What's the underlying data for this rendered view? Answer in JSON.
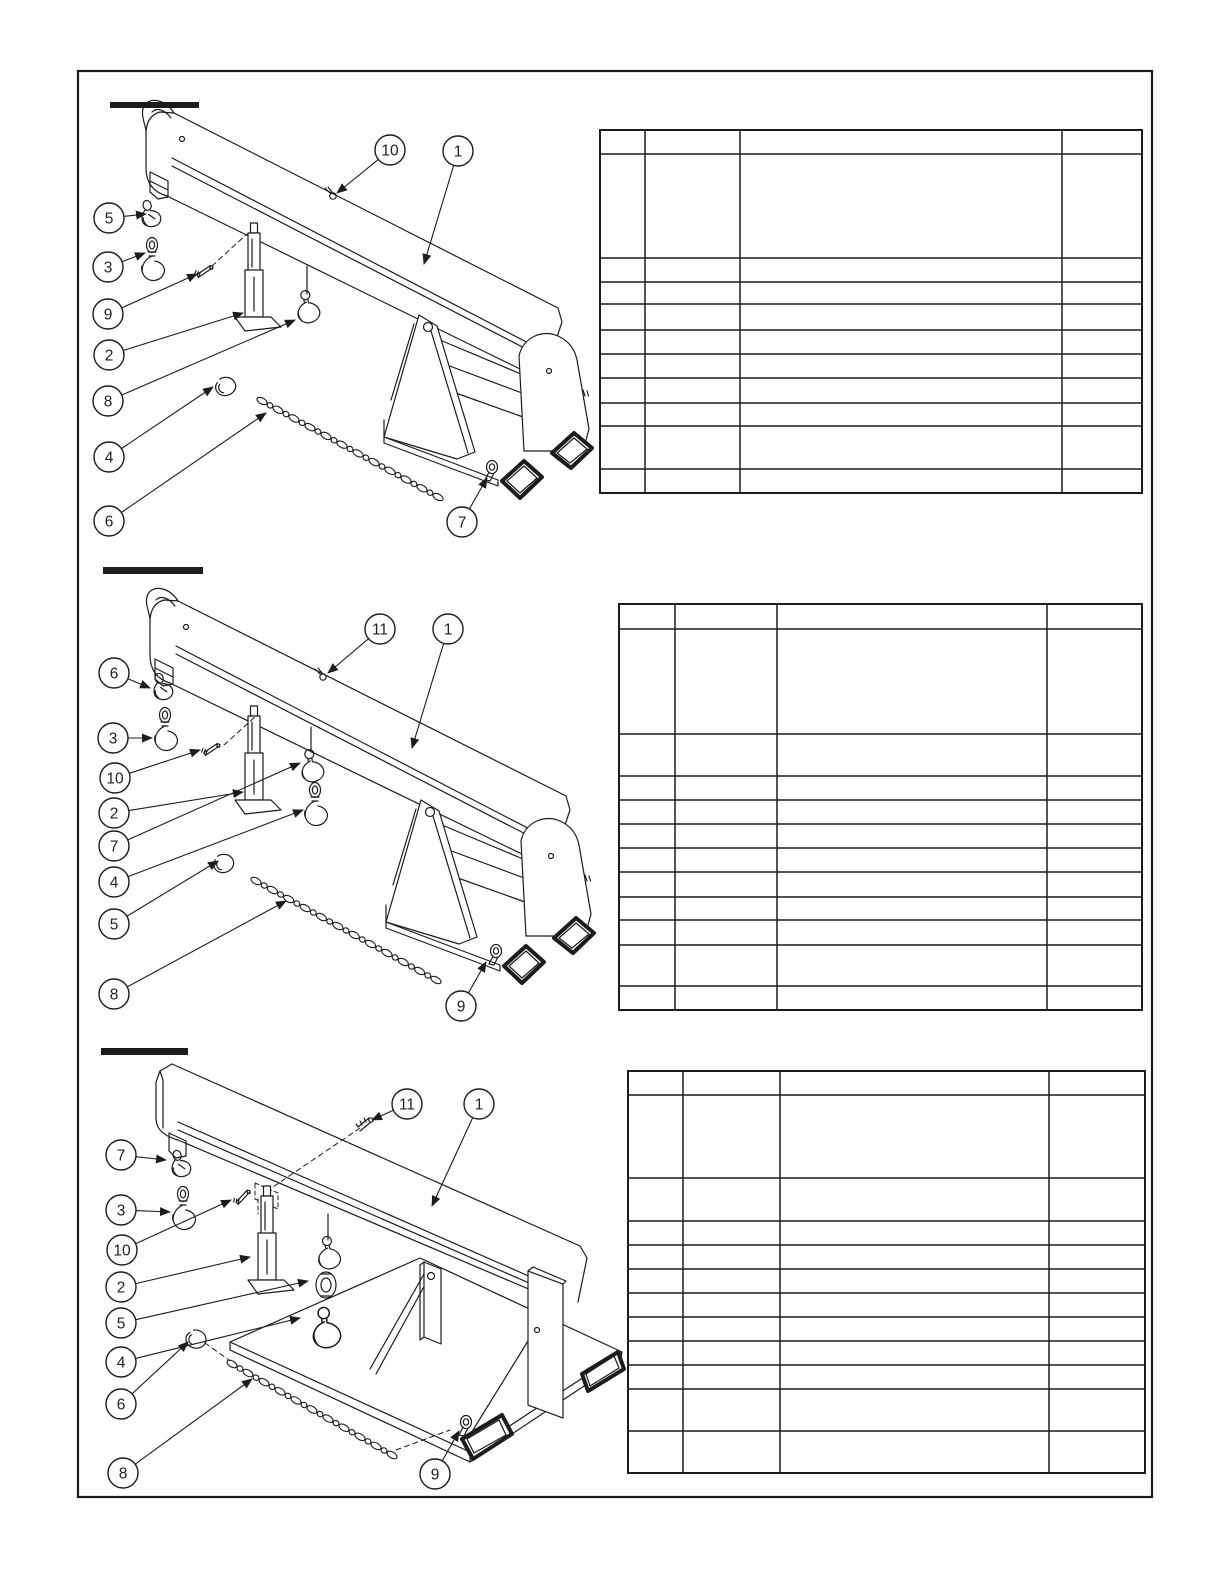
{
  "page": {
    "background": "#ffffff",
    "ink": "#1c1c1c",
    "border": {
      "x": 78,
      "y": 71,
      "width": 1074,
      "height": 1426
    },
    "kind": "exploded parts diagram sheet with three figures, redacted section titles and blank parts tables"
  },
  "sections": [
    {
      "name": "figure-1",
      "redacted_title_bar": {
        "x": 110,
        "y": 102,
        "width": 89,
        "height": 6
      },
      "callout_radius": 15,
      "callouts": [
        {
          "label": "10",
          "cx": 390,
          "cy": 150,
          "tx": 337,
          "ty": 193
        },
        {
          "label": "1",
          "cx": 458,
          "cy": 151,
          "tx": 424,
          "ty": 264
        },
        {
          "label": "5",
          "cx": 109,
          "cy": 218,
          "tx": 146,
          "ty": 214
        },
        {
          "label": "3",
          "cx": 108,
          "cy": 267,
          "tx": 145,
          "ty": 253
        },
        {
          "label": "9",
          "cx": 108,
          "cy": 314,
          "tx": 197,
          "ty": 274
        },
        {
          "label": "2",
          "cx": 109,
          "cy": 355,
          "tx": 243,
          "ty": 313
        },
        {
          "label": "8",
          "cx": 108,
          "cy": 401,
          "tx": 295,
          "ty": 320
        },
        {
          "label": "4",
          "cx": 109,
          "cy": 457,
          "tx": 213,
          "ty": 387
        },
        {
          "label": "6",
          "cx": 109,
          "cy": 521,
          "tx": 266,
          "ty": 413
        },
        {
          "label": "7",
          "cx": 462,
          "cy": 522,
          "tx": 487,
          "ty": 478
        }
      ],
      "chain": {
        "x1": 262,
        "y1": 401,
        "x2": 438,
        "y2": 497
      },
      "table": {
        "x": 600,
        "y": 130,
        "col_widths": [
          45,
          95,
          322,
          80
        ],
        "row_heights": [
          24,
          104,
          24,
          22,
          26,
          24,
          24,
          25,
          23,
          43,
          24
        ]
      }
    },
    {
      "name": "figure-2",
      "redacted_title_bar": {
        "x": 103,
        "y": 567,
        "width": 100,
        "height": 7
      },
      "callout_radius": 15,
      "callouts": [
        {
          "label": "11",
          "cx": 380,
          "cy": 629,
          "tx": 328,
          "ty": 673
        },
        {
          "label": "1",
          "cx": 448,
          "cy": 629,
          "tx": 412,
          "ty": 748
        },
        {
          "label": "6",
          "cx": 114,
          "cy": 673,
          "tx": 150,
          "ty": 688
        },
        {
          "label": "3",
          "cx": 113,
          "cy": 738,
          "tx": 152,
          "ty": 738
        },
        {
          "label": "10",
          "cx": 115,
          "cy": 778,
          "tx": 200,
          "ty": 750
        },
        {
          "label": "2",
          "cx": 114,
          "cy": 813,
          "tx": 243,
          "ty": 792
        },
        {
          "label": "7",
          "cx": 114,
          "cy": 846,
          "tx": 300,
          "ty": 763
        },
        {
          "label": "4",
          "cx": 114,
          "cy": 882,
          "tx": 303,
          "ty": 810
        },
        {
          "label": "5",
          "cx": 114,
          "cy": 924,
          "tx": 218,
          "ty": 861
        },
        {
          "label": "8",
          "cx": 114,
          "cy": 994,
          "tx": 286,
          "ty": 901
        },
        {
          "label": "9",
          "cx": 461,
          "cy": 1006,
          "tx": 486,
          "ty": 962
        }
      ],
      "chain": {
        "x1": 256,
        "y1": 881,
        "x2": 436,
        "y2": 980
      },
      "table": {
        "x": 619,
        "y": 604,
        "col_widths": [
          56,
          102,
          270,
          95
        ],
        "row_heights": [
          25,
          105,
          42,
          24,
          24,
          24,
          24,
          25,
          23,
          25,
          41,
          24
        ]
      }
    },
    {
      "name": "figure-3",
      "redacted_title_bar": {
        "x": 101,
        "y": 1048,
        "width": 87,
        "height": 7
      },
      "callout_radius": 15,
      "callouts": [
        {
          "label": "11",
          "cx": 407,
          "cy": 1104,
          "tx": 372,
          "ty": 1120
        },
        {
          "label": "1",
          "cx": 479,
          "cy": 1104,
          "tx": 432,
          "ty": 1206
        },
        {
          "label": "7",
          "cx": 121,
          "cy": 1155,
          "tx": 166,
          "ty": 1160
        },
        {
          "label": "3",
          "cx": 121,
          "cy": 1210,
          "tx": 170,
          "ty": 1212
        },
        {
          "label": "10",
          "cx": 122,
          "cy": 1250,
          "tx": 231,
          "ty": 1200
        },
        {
          "label": "2",
          "cx": 121,
          "cy": 1287,
          "tx": 250,
          "ty": 1257
        },
        {
          "label": "5",
          "cx": 121,
          "cy": 1323,
          "tx": 308,
          "ty": 1281
        },
        {
          "label": "4",
          "cx": 121,
          "cy": 1362,
          "tx": 300,
          "ty": 1318
        },
        {
          "label": "6",
          "cx": 121,
          "cy": 1404,
          "tx": 188,
          "ty": 1342
        },
        {
          "label": "8",
          "cx": 123,
          "cy": 1473,
          "tx": 252,
          "ty": 1379
        },
        {
          "label": "9",
          "cx": 435,
          "cy": 1474,
          "tx": 459,
          "ty": 1431
        }
      ],
      "chain": {
        "x1": 232,
        "y1": 1364,
        "x2": 392,
        "y2": 1455
      },
      "table": {
        "x": 628,
        "y": 1071,
        "col_widths": [
          55,
          97,
          269,
          96
        ],
        "row_heights": [
          24,
          83,
          43,
          24,
          24,
          24,
          24,
          24,
          24,
          24,
          42,
          42
        ]
      }
    }
  ]
}
